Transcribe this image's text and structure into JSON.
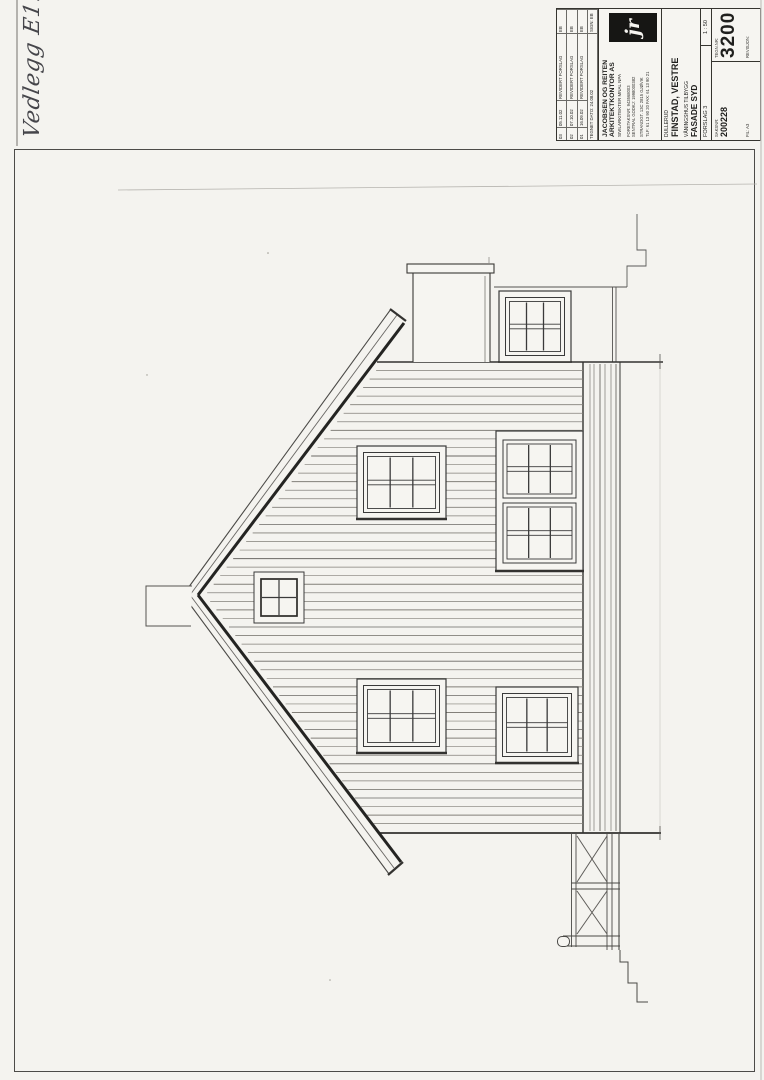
{
  "annotation": {
    "text": "Vedlegg E1."
  },
  "title_block": {
    "revision_table": {
      "rows": [
        {
          "nr": "03",
          "date": "05.11.02",
          "desc": "REVIDERT FORSLAG",
          "sign": "EB"
        },
        {
          "nr": "02",
          "date": "07.10.02",
          "desc": "REVIDERT FORSLAG",
          "sign": "EB"
        },
        {
          "nr": "01",
          "date": "16.09.02",
          "desc": "REVIDERT FORSLAG",
          "sign": "EB"
        }
      ],
      "footer": {
        "label": "TEGNET DATO: 24.08.02",
        "sign": "SIGN: EB"
      }
    },
    "architect": {
      "logo": "jr",
      "name_line1": "JACOBSEN OG REITEN",
      "name_line2": "ARKITEKTKONTOR AS",
      "subtitle": "SIVILARKITEKTER MNAL NPA",
      "org_line1": "FORETAKSNR: 943568003",
      "org_line2": "SENTRAL GODKJ: 1998000382",
      "address": "STRANDGT. 13C  2815 GJØVIK",
      "phone": "TLF: 61 13 90 20   FAX: 61 13 90 21"
    },
    "project": {
      "client": "DULLERUD",
      "name": "FINSTAD, VESTRE",
      "description": "VÅNINGSHUS TILBYGG",
      "drawing_title": "FASADE SYD",
      "stage": "FORSLAG 3",
      "scale": "1 : 50"
    },
    "numbers": {
      "drawing_no_label": "TEGN.NR:",
      "drawing_no": "3200",
      "case_no_label": "SAKSNR:",
      "case_no": "200228",
      "file": "FIL: A3",
      "revision_label": "REVISJON:"
    }
  },
  "drawing_colors": {
    "ink": "#3a3a3a",
    "paper": "#f4f3ef",
    "logo_bg": "#161614"
  }
}
